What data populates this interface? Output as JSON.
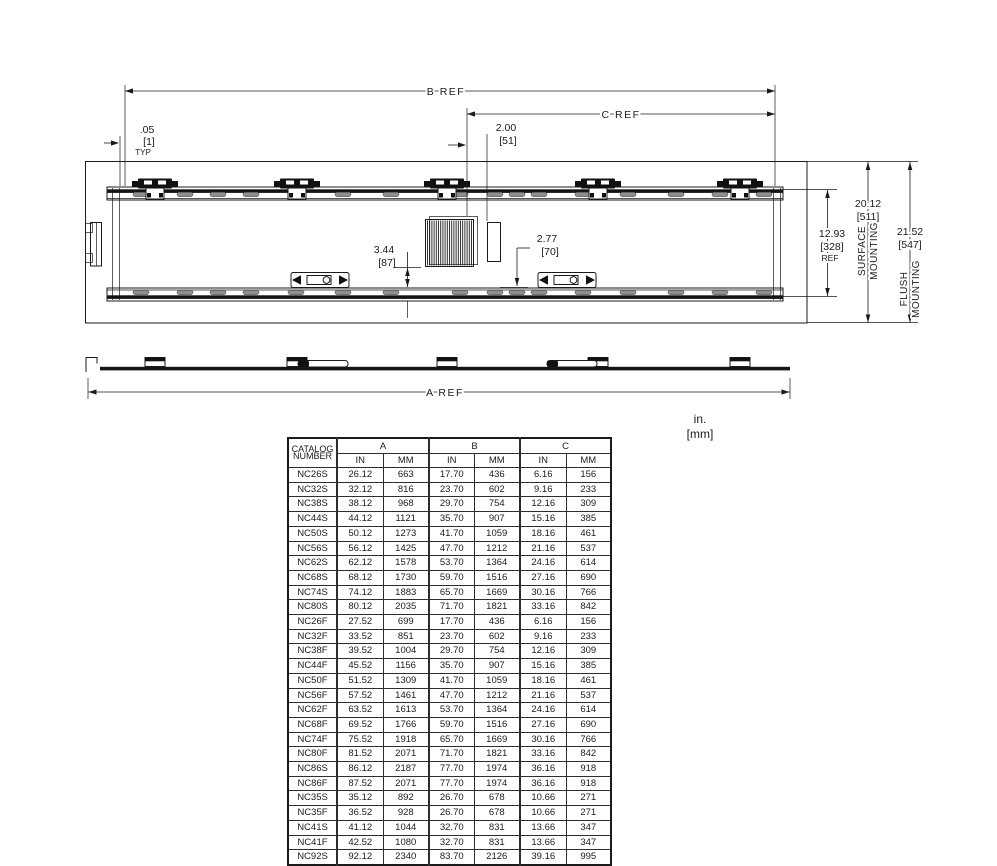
{
  "units_note": {
    "inches": "in.",
    "millimeters": "[mm]"
  },
  "drawing": {
    "front_view": {
      "b_ref_label": "B REF",
      "c_ref_label": "C REF",
      "edge_gap": {
        "inches": ".05",
        "millimeters": "[1]",
        "note": "TYP"
      },
      "c_ref_offset": {
        "inches": "2.00",
        "millimeters": "[51]"
      },
      "vent_dim": {
        "inches": "3.44",
        "millimeters": "[87]"
      },
      "latch_dim": {
        "inches": "2.77",
        "millimeters": "[70]"
      },
      "inner_height": {
        "inches": "12.93",
        "millimeters": "[328]",
        "note": "REF"
      },
      "surface_height": {
        "inches": "20.12",
        "millimeters": "[511]"
      },
      "flush_height": {
        "inches": "21.52",
        "millimeters": "[547]"
      },
      "surface_mounting": [
        "SURFACE",
        "MOUNTING"
      ],
      "flush_mounting": [
        "FLUSH",
        "MOUNTING"
      ]
    },
    "profile_view": {
      "a_ref_label": "A REF"
    }
  },
  "table": {
    "header": {
      "catalog": [
        "CATALOG",
        "NUMBER"
      ],
      "groups": [
        "A",
        "B",
        "C"
      ],
      "subheaders": [
        "IN",
        "MM"
      ]
    },
    "rows": [
      [
        "NC26S",
        "26.12",
        "663",
        "17.70",
        "436",
        "6.16",
        "156"
      ],
      [
        "NC32S",
        "32.12",
        "816",
        "23.70",
        "602",
        "9.16",
        "233"
      ],
      [
        "NC38S",
        "38.12",
        "968",
        "29.70",
        "754",
        "12.16",
        "309"
      ],
      [
        "NC44S",
        "44.12",
        "1121",
        "35.70",
        "907",
        "15.16",
        "385"
      ],
      [
        "NC50S",
        "50.12",
        "1273",
        "41.70",
        "1059",
        "18.16",
        "461"
      ],
      [
        "NC56S",
        "56.12",
        "1425",
        "47.70",
        "1212",
        "21.16",
        "537"
      ],
      [
        "NC62S",
        "62.12",
        "1578",
        "53.70",
        "1364",
        "24.16",
        "614"
      ],
      [
        "NC68S",
        "68.12",
        "1730",
        "59.70",
        "1516",
        "27.16",
        "690"
      ],
      [
        "NC74S",
        "74.12",
        "1883",
        "65.70",
        "1669",
        "30.16",
        "766"
      ],
      [
        "NC80S",
        "80.12",
        "2035",
        "71.70",
        "1821",
        "33.16",
        "842"
      ],
      [
        "NC26F",
        "27.52",
        "699",
        "17.70",
        "436",
        "6.16",
        "156"
      ],
      [
        "NC32F",
        "33.52",
        "851",
        "23.70",
        "602",
        "9.16",
        "233"
      ],
      [
        "NC38F",
        "39.52",
        "1004",
        "29.70",
        "754",
        "12.16",
        "309"
      ],
      [
        "NC44F",
        "45.52",
        "1156",
        "35.70",
        "907",
        "15.16",
        "385"
      ],
      [
        "NC50F",
        "51.52",
        "1309",
        "41.70",
        "1059",
        "18.16",
        "461"
      ],
      [
        "NC56F",
        "57.52",
        "1461",
        "47.70",
        "1212",
        "21.16",
        "537"
      ],
      [
        "NC62F",
        "63.52",
        "1613",
        "53.70",
        "1364",
        "24.16",
        "614"
      ],
      [
        "NC68F",
        "69.52",
        "1766",
        "59.70",
        "1516",
        "27.16",
        "690"
      ],
      [
        "NC74F",
        "75.52",
        "1918",
        "65.70",
        "1669",
        "30.16",
        "766"
      ],
      [
        "NC80F",
        "81.52",
        "2071",
        "71.70",
        "1821",
        "33.16",
        "842"
      ],
      [
        "NC86S",
        "86.12",
        "2187",
        "77.70",
        "1974",
        "36.16",
        "918"
      ],
      [
        "NC86F",
        "87.52",
        "2071",
        "77.70",
        "1974",
        "36.16",
        "918"
      ],
      [
        "NC35S",
        "35.12",
        "892",
        "26.70",
        "678",
        "10.66",
        "271"
      ],
      [
        "NC35F",
        "36.52",
        "928",
        "26.70",
        "678",
        "10.66",
        "271"
      ],
      [
        "NC41S",
        "41.12",
        "1044",
        "32.70",
        "831",
        "13.66",
        "347"
      ],
      [
        "NC41F",
        "42.52",
        "1080",
        "32.70",
        "831",
        "13.66",
        "347"
      ],
      [
        "NC92S",
        "92.12",
        "2340",
        "83.70",
        "2126",
        "39.16",
        "995"
      ]
    ]
  },
  "colors": {
    "line": "#1b1b1b",
    "slot": "#8f8f8f",
    "text": "#1b1b1b"
  }
}
